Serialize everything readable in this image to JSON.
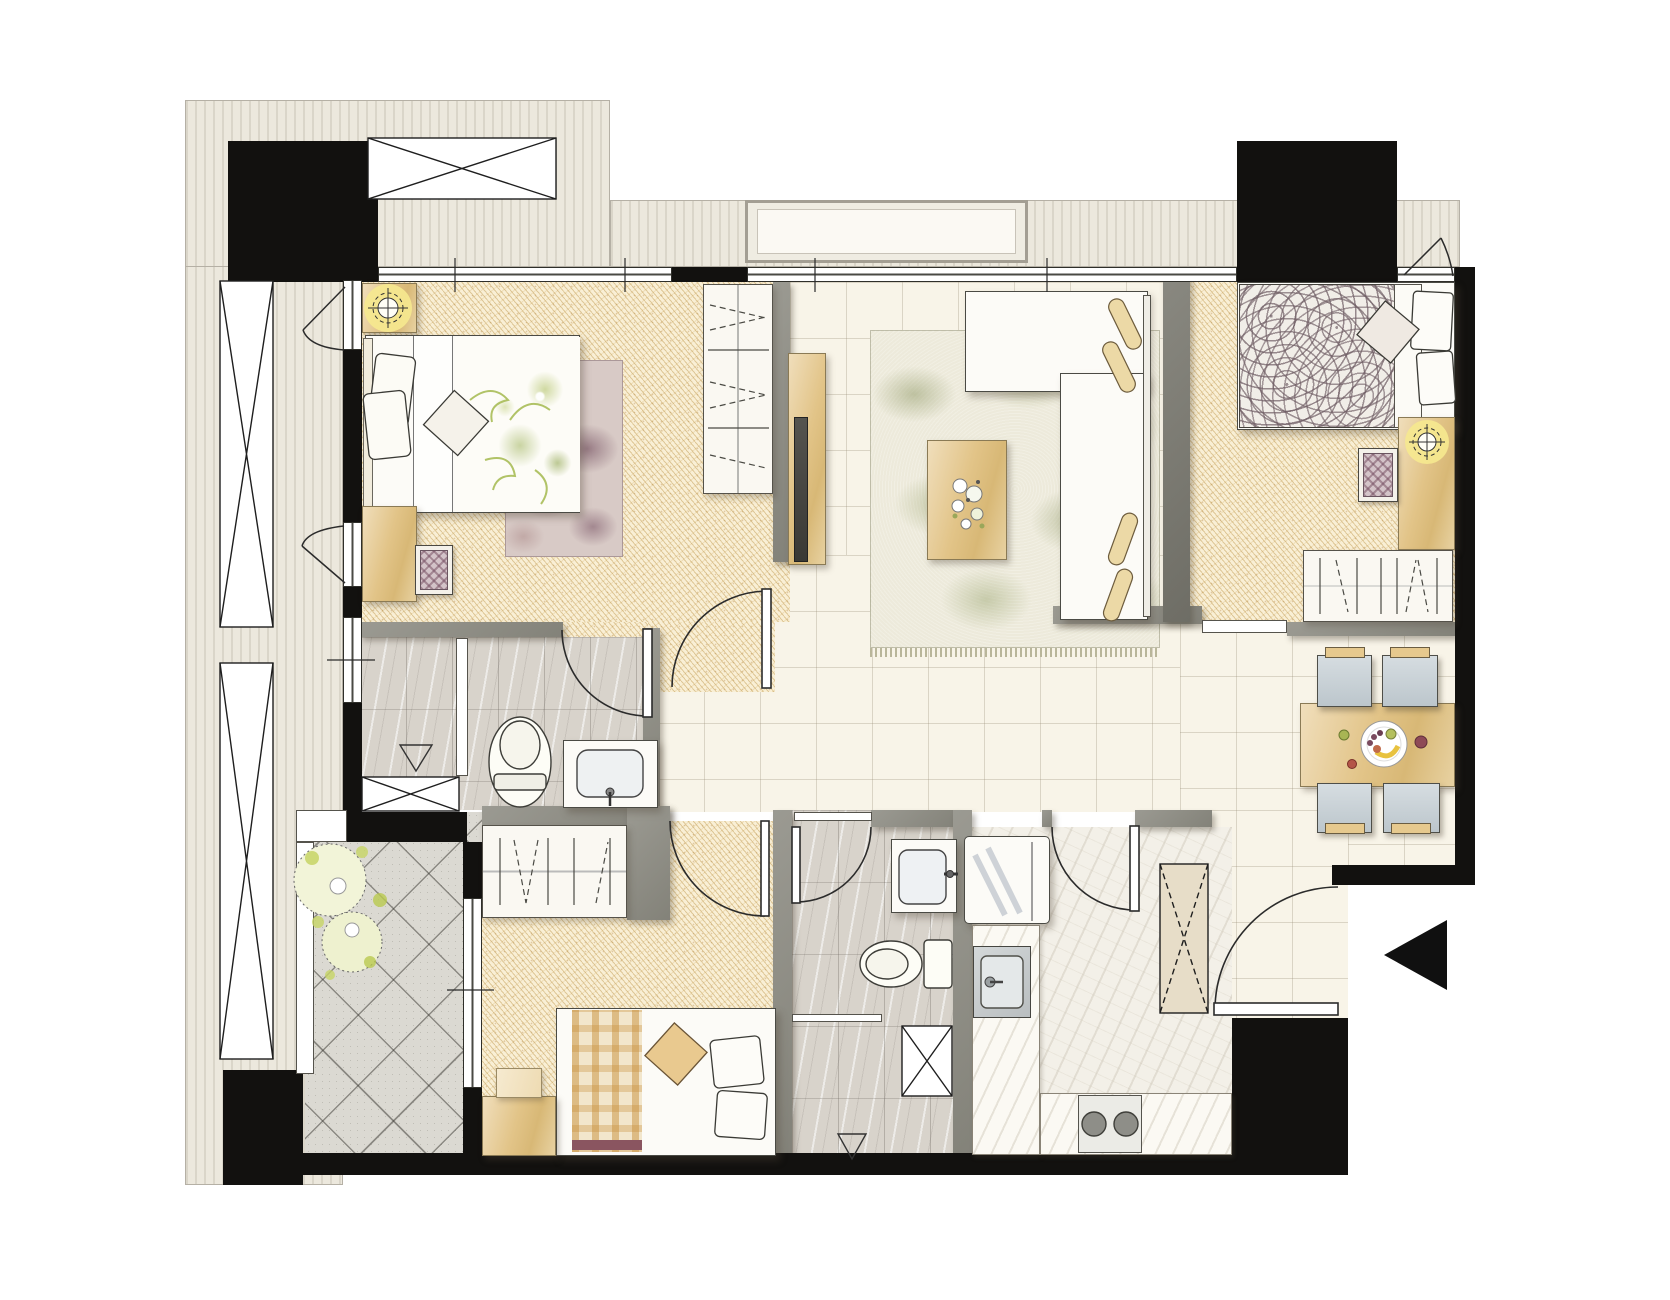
{
  "colors": {
    "canvas": "#ffffff",
    "wall_black": "#12110f",
    "wall_grey": "#8f8e86",
    "exterior_band": "#ece8dd",
    "floor_tile": "#f8f4e8",
    "floor_hatch": "#f9efd5",
    "floor_marble": "#d8d3cb",
    "floor_kitchen": "#f3f0e8",
    "floor_balcony": "#dbd9d2",
    "rug_green": "#edeadb",
    "rug_purple": "#d8cac6",
    "wood": "#e6c98e",
    "furniture_white": "#fcfbf7",
    "chair_grey": "#ccd4d9",
    "light_glow": "#f6e98f",
    "plant_green": "#c7d465",
    "duvet_swirl": "#6f5d64",
    "line_dark": "#2b2b2b"
  },
  "symbols": [
    "door-swing-arc",
    "casement-window-swing",
    "window-band",
    "window-tick",
    "ceiling-light",
    "floor-drain-triangle",
    "entry-direction-arrow",
    "shaft-cross-box",
    "wardrobe-hanger-dashes",
    "potted-plant",
    "fruit-plate"
  ],
  "floor_plan": {
    "rooms": [
      {
        "name": "bedroom-1",
        "floor": "gold-hatch",
        "contents": [
          "double-bed-floral-duvet",
          "pillows",
          "headboard",
          "nightstand",
          "ceiling-light",
          "area-rug-purple",
          "dresser",
          "stool",
          "wardrobe",
          "tv-cabinet"
        ]
      },
      {
        "name": "living-room",
        "floor": "cream-tile",
        "contents": [
          "l-shaped-sofa",
          "bolster-pillows",
          "coffee-table",
          "flower-bouquet",
          "leaf-pattern-rug",
          "tv-panel"
        ]
      },
      {
        "name": "bedroom-2",
        "floor": "gold-hatch",
        "contents": [
          "double-bed-swirl-duvet",
          "pillows",
          "desk",
          "stool",
          "ceiling-light",
          "wardrobe",
          "closed-door"
        ]
      },
      {
        "name": "dining-area",
        "floor": "cream-tile",
        "contents": [
          "dining-table",
          "fruit-plate",
          "chair",
          "chair",
          "chair",
          "chair"
        ]
      },
      {
        "name": "bathroom-1",
        "floor": "marble-tile",
        "contents": [
          "shower-with-glass-partition",
          "floor-drain",
          "toilet",
          "vanity-sink",
          "shaft-box",
          "door-swing"
        ]
      },
      {
        "name": "bedroom-3",
        "floor": "gold-hatch",
        "contents": [
          "double-bed-plaid-blanket",
          "pillows",
          "nightstand",
          "wardrobe",
          "door-swing"
        ]
      },
      {
        "name": "bathroom-2",
        "floor": "marble-tile",
        "contents": [
          "vanity-sink",
          "toilet",
          "shower",
          "floor-drain",
          "shaft-box",
          "door-swing"
        ]
      },
      {
        "name": "kitchen",
        "floor": "light-marble",
        "contents": [
          "refrigerator",
          "kitchen-sink",
          "two-burner-cooktop",
          "l-shaped-counter",
          "door-swing"
        ]
      },
      {
        "name": "balcony",
        "floor": "diagonal-tile",
        "contents": [
          "potted-plant",
          "sliding-window"
        ]
      },
      {
        "name": "entry-foyer",
        "contents": [
          "entry-door-swing",
          "direction-arrow"
        ]
      }
    ],
    "structural": [
      "left-shaft-band-with-cross-boxes",
      "top-duct-cross-box",
      "concrete-columns-black",
      "north-window-band",
      "west-casement-windows",
      "ac-ledge-niche",
      "east-wall",
      "south-wall"
    ]
  }
}
